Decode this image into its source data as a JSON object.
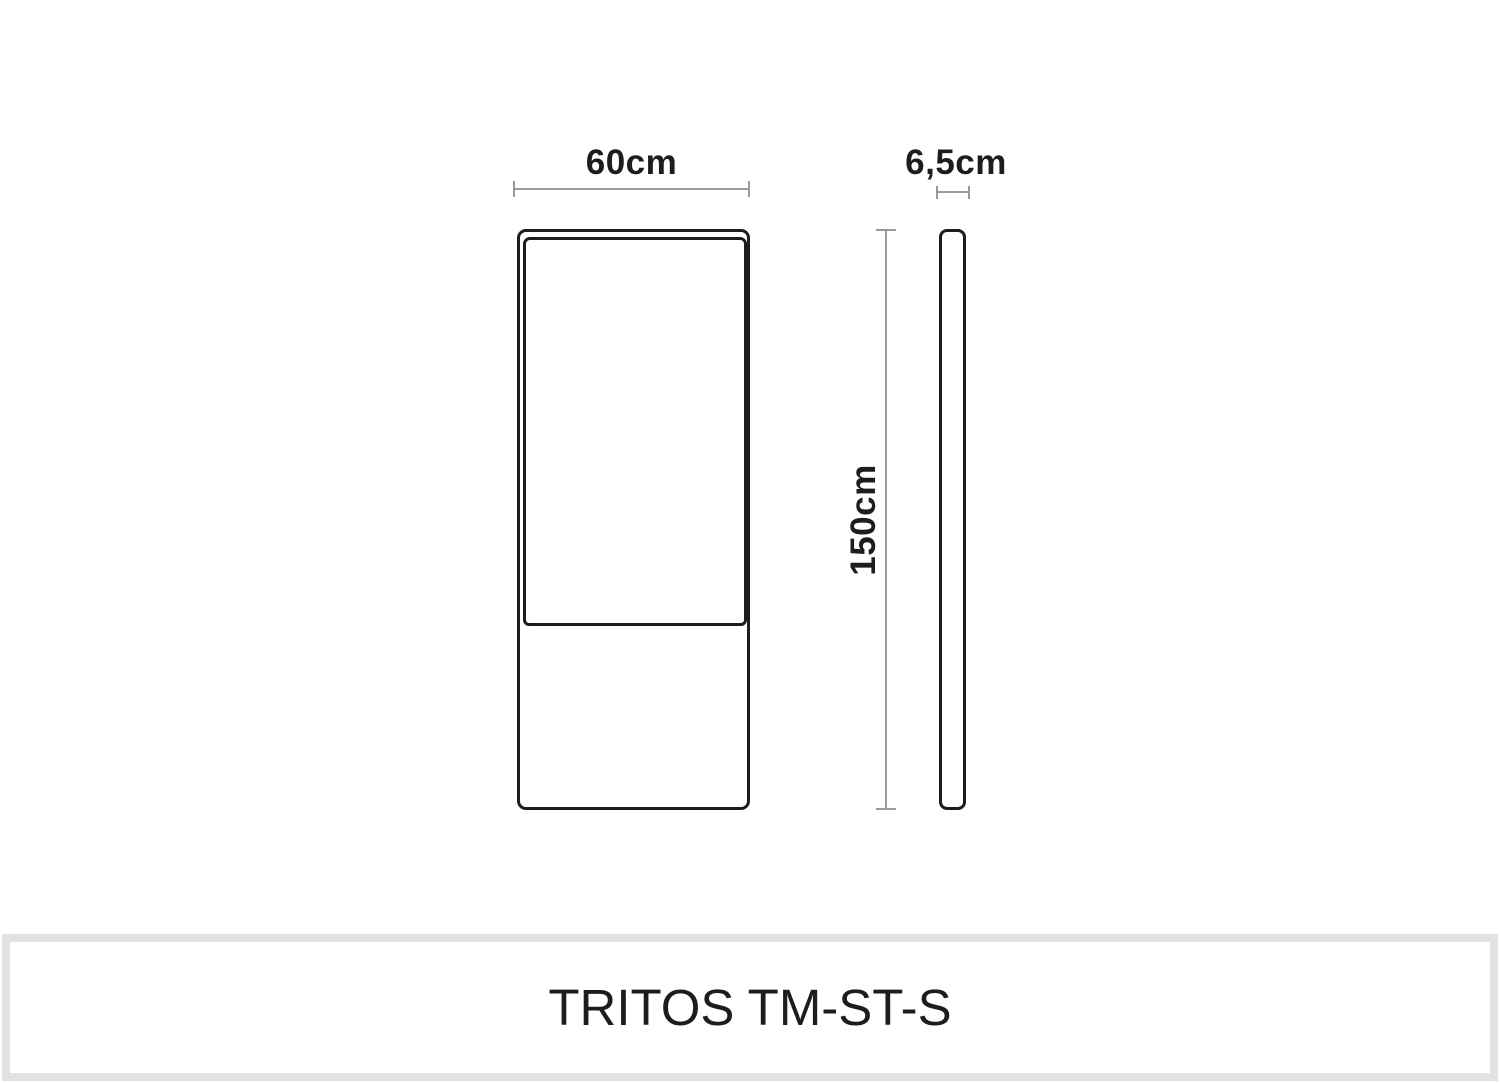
{
  "product": {
    "model": "TRITOS TM-ST-S"
  },
  "diagram": {
    "type": "product-dimension-drawing",
    "views": {
      "front": {
        "name": "front view",
        "width_label": "60cm",
        "height_label": "150cm",
        "parts": [
          "screen-panel",
          "base-panel"
        ]
      },
      "side": {
        "name": "side profile view",
        "depth_label": "6,5cm"
      }
    }
  },
  "colors": {
    "outline": "#1d1d1b",
    "dimension_line": "#9a9a9a",
    "banner_border": "#e2e2e2",
    "background": "#ffffff",
    "text": "#1d1d1b"
  }
}
